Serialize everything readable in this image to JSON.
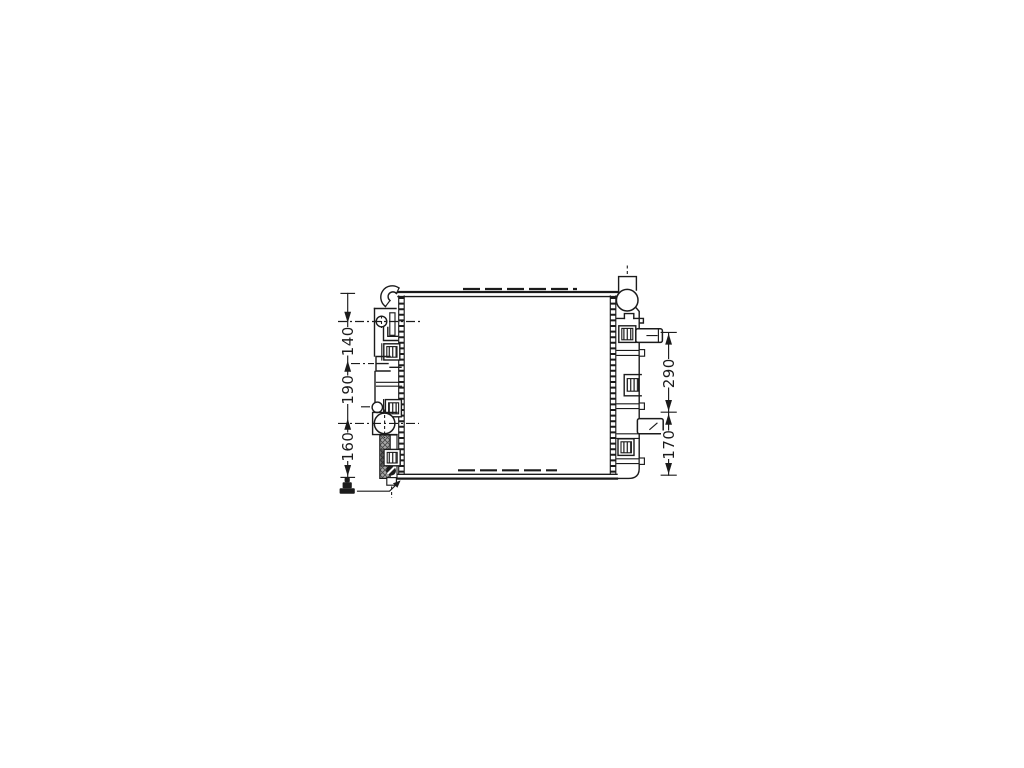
{
  "colors": {
    "background": "#ffffff",
    "line": "#1b1b1b",
    "hatch_gray": "#a8a8a8"
  },
  "dimensions": {
    "left": [
      {
        "label": "140"
      },
      {
        "label": "190"
      },
      {
        "label": "160"
      }
    ],
    "right": [
      {
        "label": "290"
      },
      {
        "label": "170"
      }
    ]
  },
  "icons": [
    {
      "name": "drain-plug-icon"
    }
  ]
}
